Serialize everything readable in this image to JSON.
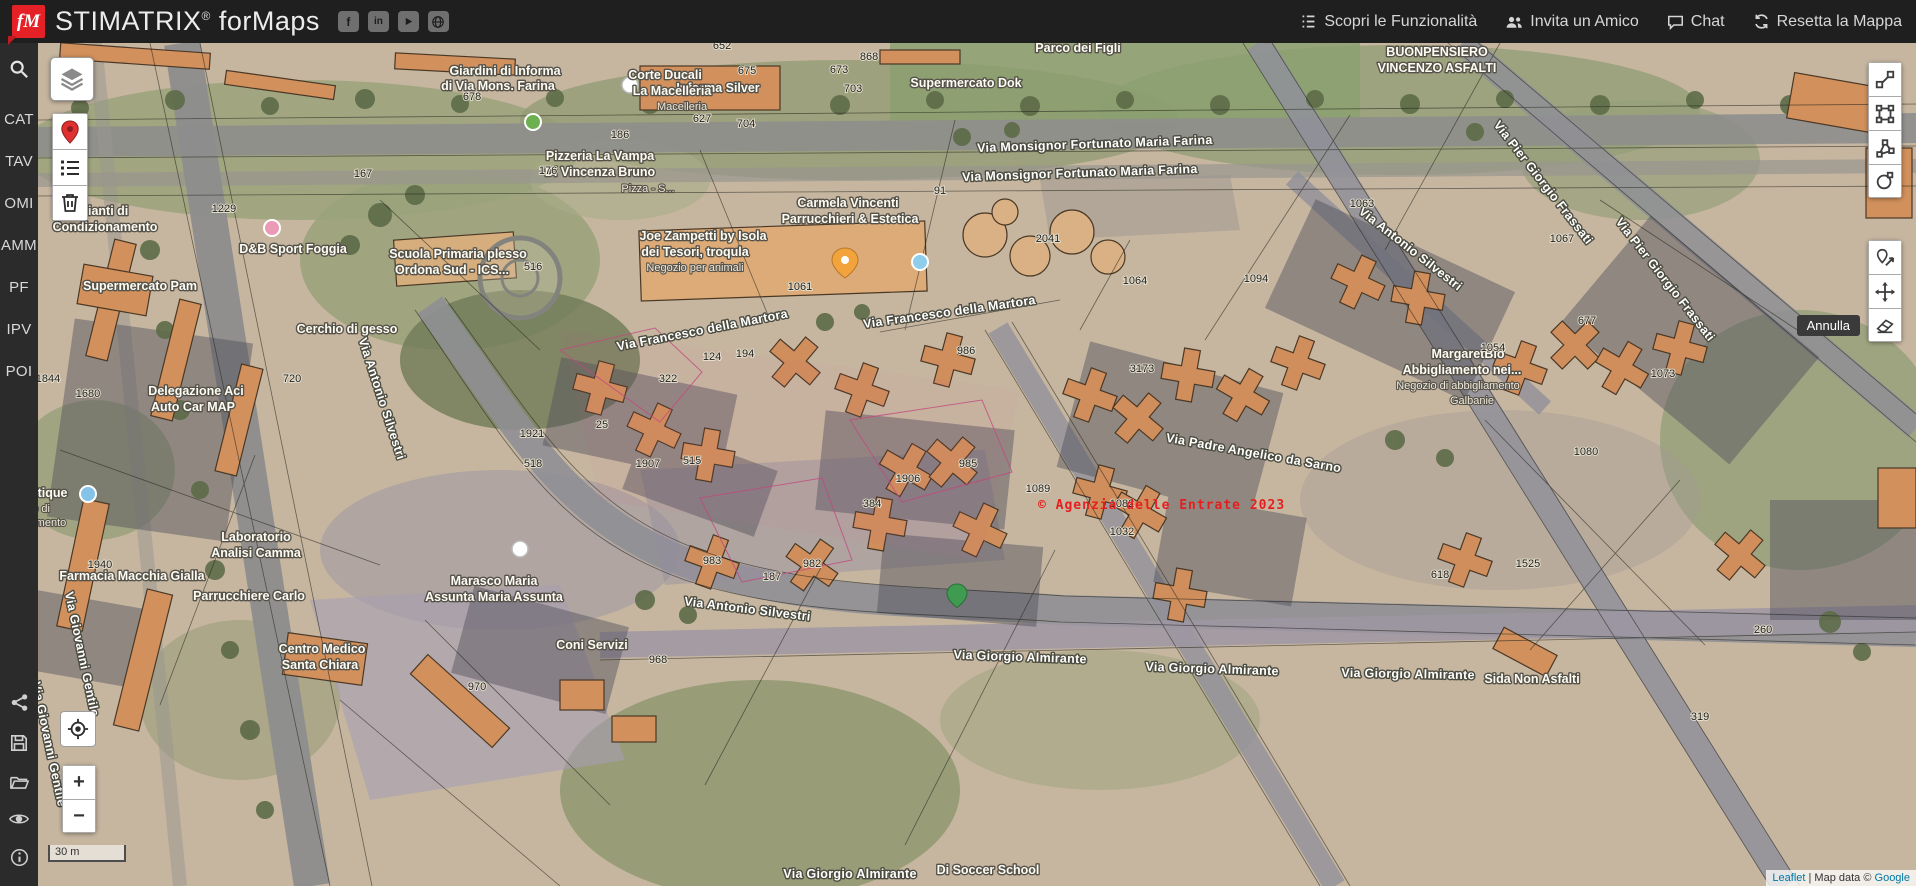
{
  "header": {
    "logo_text": "fM",
    "brand": "STIMATRIX",
    "brand_reg": "®",
    "brand_suffix": "forMaps",
    "social_icons": [
      "facebook-icon",
      "linkedin-icon",
      "youtube-icon",
      "globe-icon"
    ],
    "menu": [
      {
        "label": "Scopri le Funzionalità",
        "icon": "list-icon"
      },
      {
        "label": "Invita un Amico",
        "icon": "users-icon"
      },
      {
        "label": "Chat",
        "icon": "chat-icon"
      },
      {
        "label": "Resetta la Mappa",
        "icon": "refresh-icon"
      }
    ]
  },
  "sidebar": {
    "search_icon": "search-icon",
    "items": [
      {
        "label": "CAT"
      },
      {
        "label": "TAV"
      },
      {
        "label": "OMI"
      },
      {
        "label": "AMM"
      },
      {
        "label": "PF"
      },
      {
        "label": "IPV"
      },
      {
        "label": "POI"
      }
    ],
    "bottom_icons": [
      "share-icon",
      "save-icon",
      "folder-icon",
      "eye-icon",
      "info-icon"
    ]
  },
  "controls": {
    "zoom_in": "+",
    "zoom_out": "−",
    "undo_tooltip": "Annulla",
    "scale_label": "30 m",
    "toolbar_icons": [
      "polyline-icon",
      "rectangle-icon",
      "polygon-icon",
      "circle-icon",
      "edit-layers-icon",
      "move-icon",
      "eraser-icon"
    ]
  },
  "map": {
    "watermark": "© Agenzia delle Entrate 2023",
    "attribution": {
      "leaflet": "Leaflet",
      "separator": " | Map data © ",
      "provider": "Google"
    },
    "street_labels": [
      {
        "text": "Via Monsignor Fortunato Maria Farina",
        "x": 1095,
        "y": 148,
        "r": -2
      },
      {
        "text": "Via Monsignor Fortunato Maria Farina",
        "x": 1080,
        "y": 177,
        "r": -2
      },
      {
        "text": "Via Francesco della Martora",
        "x": 703,
        "y": 334,
        "r": -11
      },
      {
        "text": "Via Francesco della Martora",
        "x": 950,
        "y": 316,
        "r": -8
      },
      {
        "text": "Via Antonio Silvestri",
        "x": 378,
        "y": 400,
        "r": 72
      },
      {
        "text": "Via Antonio Silvestri",
        "x": 1408,
        "y": 252,
        "r": 38
      },
      {
        "text": "Via Antonio Silvestri",
        "x": 747,
        "y": 613,
        "r": 7
      },
      {
        "text": "Via Padre Angelico da Sarno",
        "x": 1253,
        "y": 457,
        "r": 10
      },
      {
        "text": "Via Pier Giorgio Frassati",
        "x": 1662,
        "y": 282,
        "r": 52
      },
      {
        "text": "Via Pier Giorgio Frassati",
        "x": 1540,
        "y": 185,
        "r": 52
      },
      {
        "text": "Via Giorgio Almirante",
        "x": 1020,
        "y": 661,
        "r": 2
      },
      {
        "text": "Via Giorgio Almirante",
        "x": 1212,
        "y": 673,
        "r": 2
      },
      {
        "text": "Via Giorgio Almirante",
        "x": 1408,
        "y": 678,
        "r": 1
      },
      {
        "text": "Via Giovanni Gentile",
        "x": 78,
        "y": 655,
        "r": 78
      },
      {
        "text": "Via Giovanni Gentile",
        "x": 45,
        "y": 745,
        "r": 78
      },
      {
        "text": "Via Giorgio Almirante",
        "x": 850,
        "y": 878,
        "r": 0
      }
    ],
    "poi_labels": [
      {
        "text": "Giardini di Informa",
        "x": 505,
        "y": 75
      },
      {
        "text": "di Via Mons. Farina",
        "x": 498,
        "y": 90
      },
      {
        "text": "Informa Silver",
        "x": 718,
        "y": 92
      },
      {
        "text": "Corte Ducali",
        "x": 665,
        "y": 79
      },
      {
        "text": "La Macelleria",
        "x": 672,
        "y": 95
      },
      {
        "text": "Macelleria",
        "x": 682,
        "y": 110,
        "cls": "sub"
      },
      {
        "text": "Supermercato Dok",
        "x": 966,
        "y": 87
      },
      {
        "text": "Parco dei Figli",
        "x": 1078,
        "y": 52
      },
      {
        "text": "BUONPENSIERO",
        "x": 1437,
        "y": 56
      },
      {
        "text": "VINCENZO ASFALTI",
        "x": 1437,
        "y": 72
      },
      {
        "text": "Pizzeria La Vampa",
        "x": 600,
        "y": 160
      },
      {
        "text": "Di Vincenza Bruno",
        "x": 600,
        "y": 176
      },
      {
        "text": "Pizza - S...",
        "x": 648,
        "y": 192,
        "cls": "sub"
      },
      {
        "text": "Carmela Vincenti",
        "x": 848,
        "y": 207
      },
      {
        "text": "Parrucchieri & Estetica",
        "x": 850,
        "y": 223
      },
      {
        "text": "Joe Zampetti by Isola",
        "x": 703,
        "y": 240
      },
      {
        "text": "dei Tesori, troqula",
        "x": 695,
        "y": 256
      },
      {
        "text": "Negozio per animali",
        "x": 695,
        "y": 271,
        "cls": "sub"
      },
      {
        "text": "Impianti di",
        "x": 97,
        "y": 215
      },
      {
        "text": "Condizionamento",
        "x": 105,
        "y": 231
      },
      {
        "text": "D&B Sport Foggia",
        "x": 293,
        "y": 253
      },
      {
        "text": "Scuola Primaria plesso",
        "x": 458,
        "y": 258
      },
      {
        "text": "Ordona Sud - ICS...",
        "x": 452,
        "y": 274
      },
      {
        "text": "Supermercato Pam",
        "x": 140,
        "y": 290
      },
      {
        "text": "Cerchio di gesso",
        "x": 347,
        "y": 333
      },
      {
        "text": "Delegazione Aci",
        "x": 196,
        "y": 395
      },
      {
        "text": "Auto Car MAP",
        "x": 193,
        "y": 411
      },
      {
        "text": "MargaretBio",
        "x": 1468,
        "y": 358
      },
      {
        "text": "Abbigliamento nei...",
        "x": 1462,
        "y": 374
      },
      {
        "text": "Negozio di abbigliamento",
        "x": 1458,
        "y": 389,
        "cls": "sub"
      },
      {
        "text": "Galbanie",
        "x": 1472,
        "y": 404,
        "cls": "sub"
      },
      {
        "text": "ary boutique",
        "x": 30,
        "y": 497
      },
      {
        "text": "Negozio di",
        "x": 24,
        "y": 512,
        "cls": "sub"
      },
      {
        "text": "abbigliamento",
        "x": 32,
        "y": 526,
        "cls": "sub"
      },
      {
        "text": "Laboratorio",
        "x": 256,
        "y": 541
      },
      {
        "text": "Analisi Camma",
        "x": 256,
        "y": 557
      },
      {
        "text": "Farmacia Macchia Gialla",
        "x": 132,
        "y": 580
      },
      {
        "text": "Parrucchiere Carlo",
        "x": 249,
        "y": 600
      },
      {
        "text": "Marasco Maria",
        "x": 494,
        "y": 585
      },
      {
        "text": "Assunta Maria Assunta",
        "x": 494,
        "y": 601
      },
      {
        "text": "Centro Medico",
        "x": 322,
        "y": 653
      },
      {
        "text": "Santa Chiara",
        "x": 320,
        "y": 669
      },
      {
        "text": "Coni Servizi",
        "x": 592,
        "y": 649
      },
      {
        "text": "Sida Non Asfalti",
        "x": 1532,
        "y": 683
      },
      {
        "text": "Di Soccer School",
        "x": 988,
        "y": 874
      }
    ],
    "numbers": [
      {
        "text": "652",
        "x": 722,
        "y": 49
      },
      {
        "text": "868",
        "x": 869,
        "y": 60
      },
      {
        "text": "675",
        "x": 747,
        "y": 74
      },
      {
        "text": "673",
        "x": 839,
        "y": 73
      },
      {
        "text": "678",
        "x": 472,
        "y": 100
      },
      {
        "text": "703",
        "x": 853,
        "y": 92
      },
      {
        "text": "704",
        "x": 746,
        "y": 127
      },
      {
        "text": "627",
        "x": 702,
        "y": 122
      },
      {
        "text": "186",
        "x": 620,
        "y": 138
      },
      {
        "text": "167",
        "x": 363,
        "y": 177
      },
      {
        "text": "176",
        "x": 548,
        "y": 174
      },
      {
        "text": "91",
        "x": 940,
        "y": 194
      },
      {
        "text": "1229",
        "x": 224,
        "y": 212
      },
      {
        "text": "2041",
        "x": 1048,
        "y": 242
      },
      {
        "text": "1061",
        "x": 800,
        "y": 290
      },
      {
        "text": "516",
        "x": 533,
        "y": 270
      },
      {
        "text": "1063",
        "x": 1362,
        "y": 207
      },
      {
        "text": "1064",
        "x": 1135,
        "y": 284
      },
      {
        "text": "1094",
        "x": 1256,
        "y": 282
      },
      {
        "text": "1067",
        "x": 1562,
        "y": 242
      },
      {
        "text": "677",
        "x": 1587,
        "y": 324
      },
      {
        "text": "1073",
        "x": 1663,
        "y": 377
      },
      {
        "text": "1054",
        "x": 1493,
        "y": 351
      },
      {
        "text": "1080",
        "x": 1586,
        "y": 455
      },
      {
        "text": "194",
        "x": 745,
        "y": 357
      },
      {
        "text": "124",
        "x": 712,
        "y": 360
      },
      {
        "text": "986",
        "x": 966,
        "y": 354
      },
      {
        "text": "3173",
        "x": 1142,
        "y": 372
      },
      {
        "text": "322",
        "x": 668,
        "y": 382
      },
      {
        "text": "25",
        "x": 602,
        "y": 428
      },
      {
        "text": "1921",
        "x": 532,
        "y": 437
      },
      {
        "text": "518",
        "x": 533,
        "y": 467
      },
      {
        "text": "1907",
        "x": 648,
        "y": 467
      },
      {
        "text": "515",
        "x": 692,
        "y": 464
      },
      {
        "text": "1906",
        "x": 908,
        "y": 482
      },
      {
        "text": "985",
        "x": 968,
        "y": 467
      },
      {
        "text": "384",
        "x": 872,
        "y": 507
      },
      {
        "text": "1089",
        "x": 1038,
        "y": 492
      },
      {
        "text": "1082",
        "x": 1122,
        "y": 507
      },
      {
        "text": "1032",
        "x": 1122,
        "y": 535
      },
      {
        "text": "983",
        "x": 712,
        "y": 564
      },
      {
        "text": "982",
        "x": 812,
        "y": 567
      },
      {
        "text": "187",
        "x": 772,
        "y": 580
      },
      {
        "text": "1844",
        "x": 48,
        "y": 382
      },
      {
        "text": "1680",
        "x": 88,
        "y": 397
      },
      {
        "text": "720",
        "x": 292,
        "y": 382
      },
      {
        "text": "1940",
        "x": 100,
        "y": 568
      },
      {
        "text": "1525",
        "x": 1528,
        "y": 567
      },
      {
        "text": "618",
        "x": 1440,
        "y": 578
      },
      {
        "text": "968",
        "x": 658,
        "y": 663
      },
      {
        "text": "970",
        "x": 477,
        "y": 690
      },
      {
        "text": "260",
        "x": 1763,
        "y": 633
      },
      {
        "text": "319",
        "x": 1700,
        "y": 720
      }
    ]
  }
}
